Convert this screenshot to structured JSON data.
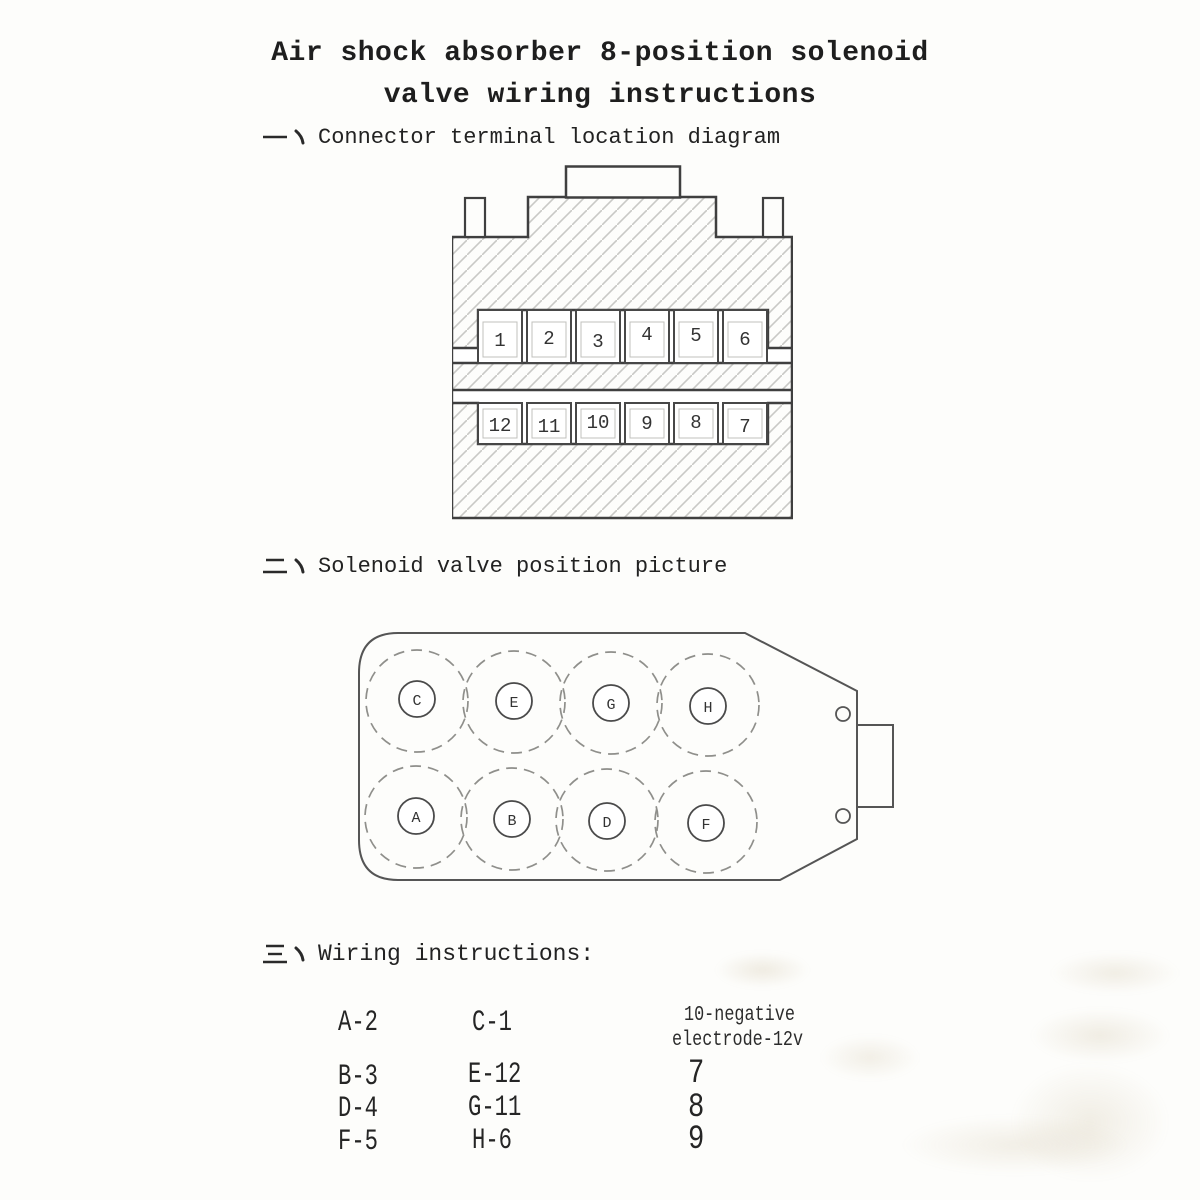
{
  "title": {
    "line1": "Air shock absorber 8-position solenoid",
    "line2": "valve wiring instructions"
  },
  "sections": [
    {
      "numeral": "一",
      "label": "Connector terminal location diagram"
    },
    {
      "numeral": "二",
      "label": "Solenoid valve position picture"
    },
    {
      "numeral": "三",
      "label": "Wiring instructions:"
    }
  ],
  "connector": {
    "top_row": [
      "1",
      "2",
      "3",
      "4",
      "5",
      "6"
    ],
    "bottom_row": [
      "12",
      "11",
      "10",
      "9",
      "8",
      "7"
    ]
  },
  "valve": {
    "top_row": [
      "C",
      "E",
      "G",
      "H"
    ],
    "bottom_row": [
      "A",
      "B",
      "D",
      "F"
    ]
  },
  "wiring": {
    "column1": [
      "A-2",
      "B-3",
      "D-4",
      "F-5"
    ],
    "column2": [
      "C-1",
      "E-12",
      "G-11",
      "H-6"
    ],
    "column3_note_line1": "10-negative",
    "column3_note_line2": "electrode-12v",
    "column3": [
      "7",
      "8",
      "9"
    ]
  },
  "colors": {
    "paper": "#fdfdfb",
    "ink": "#2a2a2a",
    "outline": "#3f3f3f",
    "hatch_line": "#c9c9c5",
    "dashed_circle": "#8f8f8b",
    "inner_rect": "#c0c0bc"
  }
}
